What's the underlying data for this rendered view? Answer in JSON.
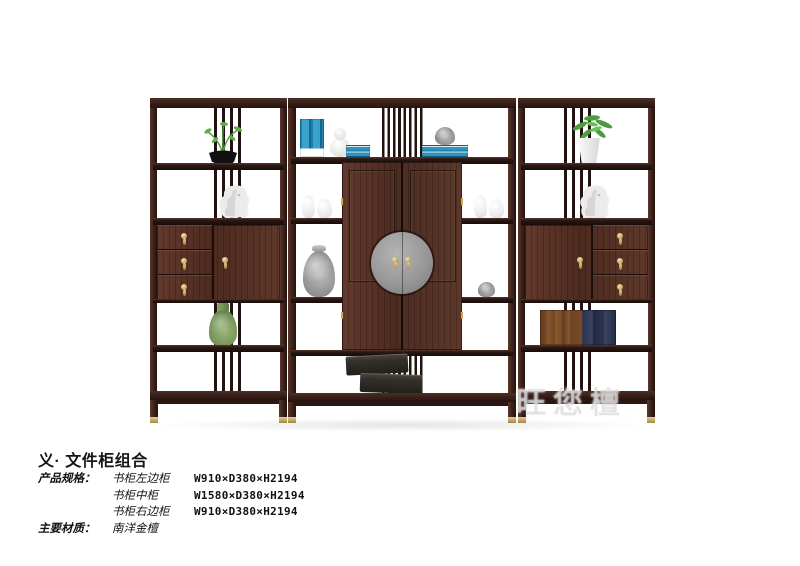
{
  "product": {
    "title": "义· 文件柜组合",
    "specs": {
      "label": "产品规格：",
      "rows": [
        {
          "name": "书柜左边柜",
          "dims": "W910×D380×H2194"
        },
        {
          "name": "书柜中柜",
          "dims": "W1580×D380×H2194"
        },
        {
          "name": "书柜右边柜",
          "dims": "W910×D380×H2194"
        }
      ]
    },
    "material": {
      "label": "主要材质：",
      "value": "南洋金檀"
    }
  },
  "watermark": "旺您檀",
  "colors": {
    "background": "#ffffff",
    "wood_frame": "#3a211a",
    "wood_panel": "#55321f",
    "brass": "#c9a95e",
    "medallion_gray": "#989898",
    "book_blue": "#2f95bf",
    "plant_green": "#4f9b3f",
    "celadon_vase": "#7fa468",
    "statue_white": "#e9e9e9",
    "box_dark": "#332f2a",
    "leather_book": "#7a4a26",
    "navy_book": "#2b3350",
    "text": "#111111"
  }
}
